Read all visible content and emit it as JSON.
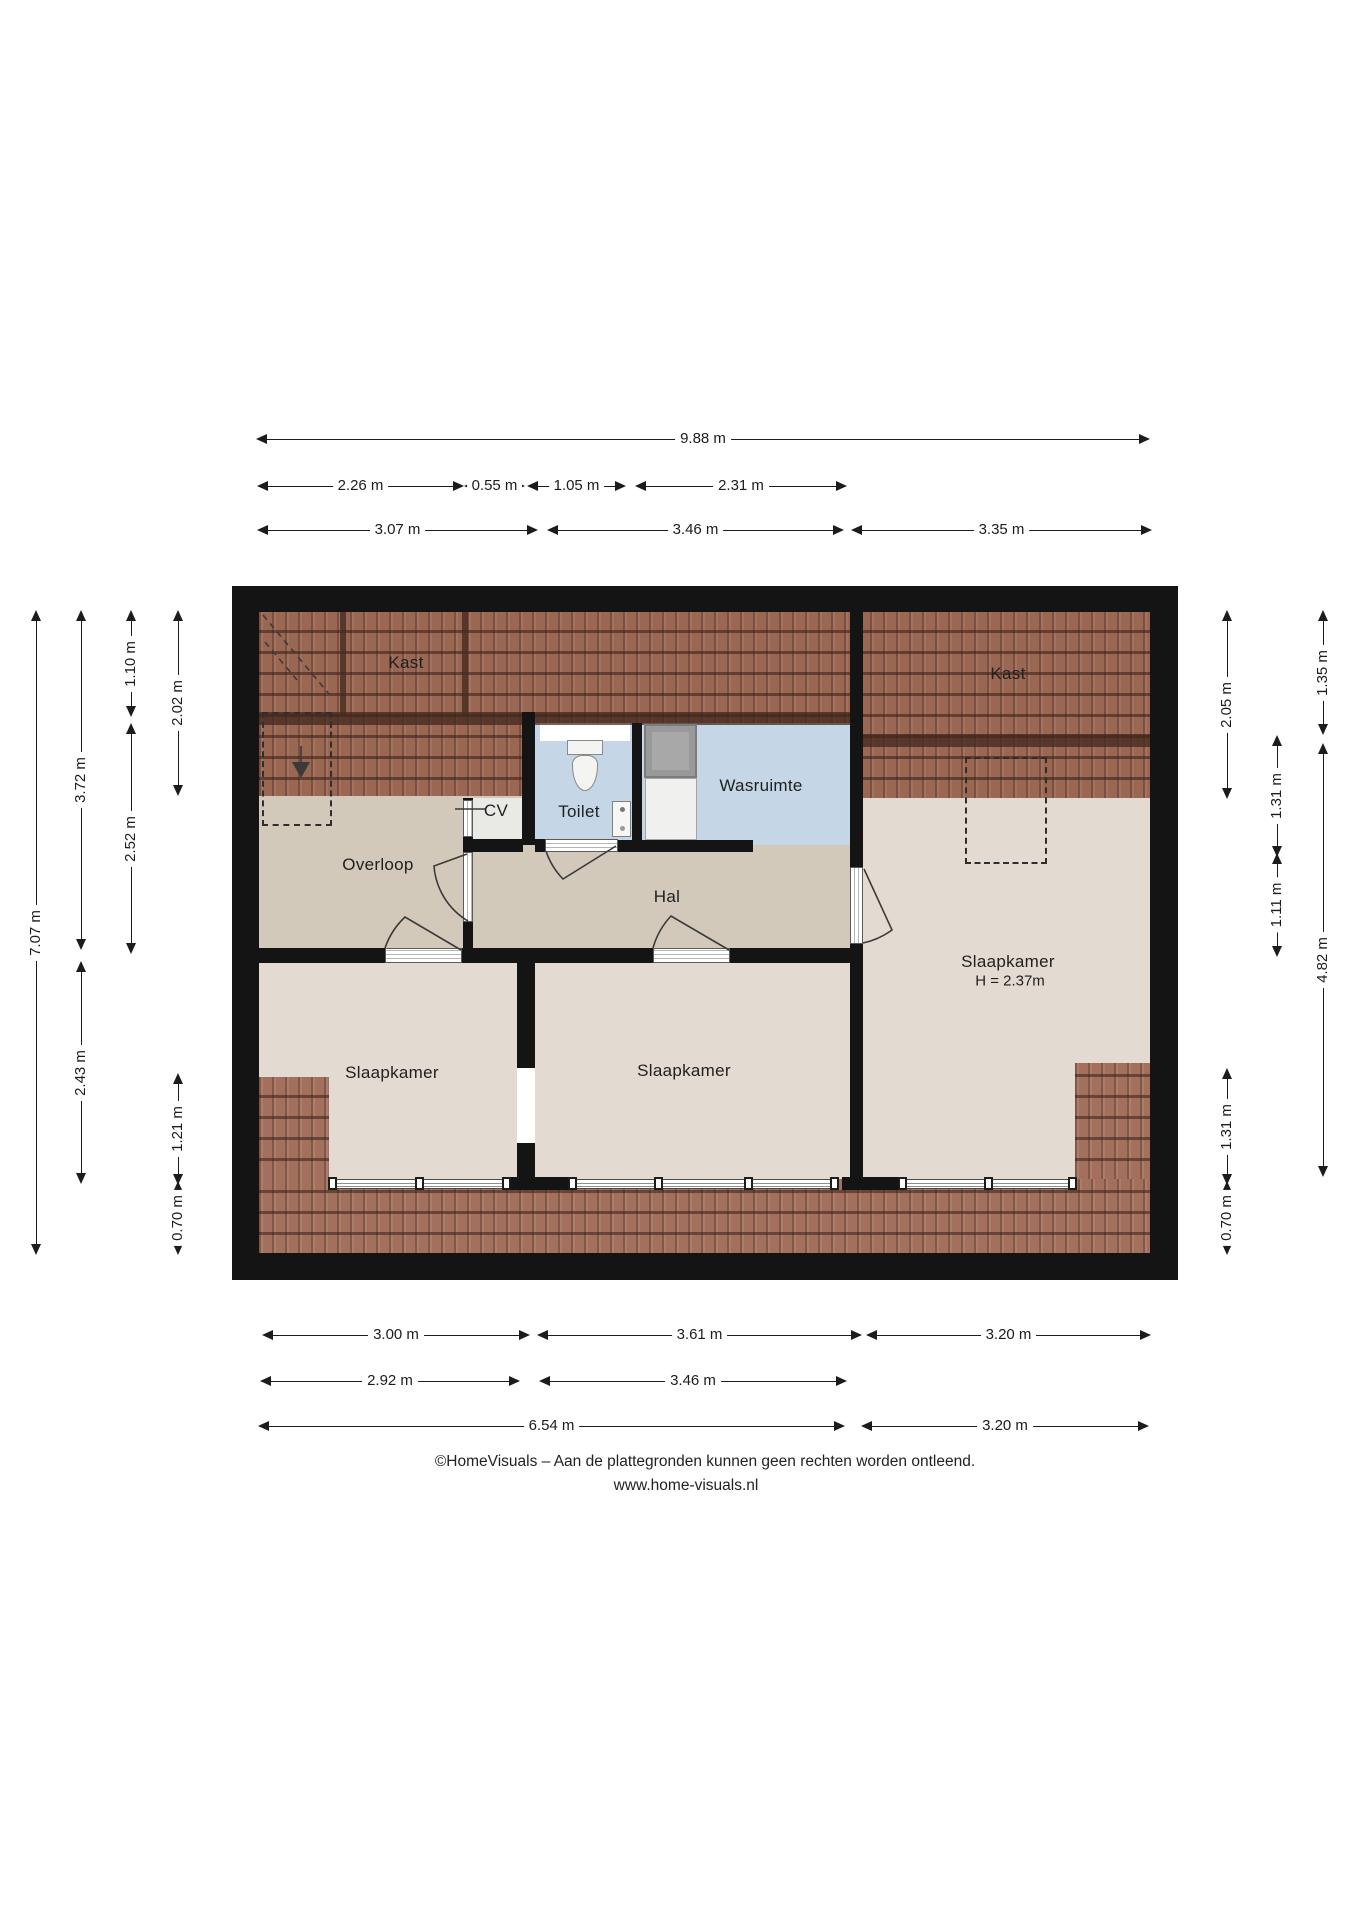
{
  "footer": {
    "line1": "©HomeVisuals – Aan de plattegronden kunnen geen rechten worden ontleend.",
    "line2": "www.home-visuals.nl"
  },
  "floorplan": {
    "rooms": [
      {
        "id": "kast-left",
        "label": "Kast",
        "x": 147,
        "y": 51
      },
      {
        "id": "kast-right",
        "label": "Kast",
        "x": 749,
        "y": 62
      },
      {
        "id": "cv",
        "label": "CV",
        "x": 237,
        "y": 199
      },
      {
        "id": "toilet",
        "label": "Toilet",
        "x": 320,
        "y": 200
      },
      {
        "id": "wasruimte",
        "label": "Wasruimte",
        "x": 502,
        "y": 174
      },
      {
        "id": "overloop",
        "label": "Overloop",
        "x": 119,
        "y": 253
      },
      {
        "id": "hal",
        "label": "Hal",
        "x": 408,
        "y": 285
      },
      {
        "id": "slaapkamer-left",
        "label": "Slaapkamer",
        "x": 133,
        "y": 461
      },
      {
        "id": "slaapkamer-mid",
        "label": "Slaapkamer",
        "x": 425,
        "y": 459
      },
      {
        "id": "slaapkamer-right",
        "label": "Slaapkamer",
        "sublabel": "H = 2.37m",
        "x": 749,
        "y": 350
      }
    ],
    "dimensions": {
      "horizontal": [
        {
          "label": "9.88 m",
          "x1": 258,
          "x2": 1148,
          "y": 439
        },
        {
          "label": "2.26 m",
          "x1": 259,
          "x2": 462,
          "y": 486
        },
        {
          "label": "0.55 m",
          "x1": 466,
          "x2": 523,
          "y": 486
        },
        {
          "label": "1.05 m",
          "x1": 529,
          "x2": 624,
          "y": 486
        },
        {
          "label": "2.31 m",
          "x1": 637,
          "x2": 845,
          "y": 486
        },
        {
          "label": "3.07 m",
          "x1": 259,
          "x2": 536,
          "y": 530
        },
        {
          "label": "3.46 m",
          "x1": 549,
          "x2": 842,
          "y": 530
        },
        {
          "label": "3.35 m",
          "x1": 853,
          "x2": 1150,
          "y": 530
        },
        {
          "label": "3.00 m",
          "x1": 264,
          "x2": 528,
          "y": 1335
        },
        {
          "label": "3.61 m",
          "x1": 539,
          "x2": 860,
          "y": 1335
        },
        {
          "label": "3.20 m",
          "x1": 868,
          "x2": 1149,
          "y": 1335
        },
        {
          "label": "2.92 m",
          "x1": 262,
          "x2": 518,
          "y": 1381
        },
        {
          "label": "3.46 m",
          "x1": 541,
          "x2": 845,
          "y": 1381
        },
        {
          "label": "6.54 m",
          "x1": 260,
          "x2": 843,
          "y": 1426
        },
        {
          "label": "3.20 m",
          "x1": 863,
          "x2": 1147,
          "y": 1426
        }
      ],
      "vertical": [
        {
          "label": "7.07 m",
          "y1": 612,
          "y2": 1253,
          "x": 36
        },
        {
          "label": "3.72 m",
          "y1": 612,
          "y2": 948,
          "x": 81
        },
        {
          "label": "2.43 m",
          "y1": 963,
          "y2": 1182,
          "x": 81
        },
        {
          "label": "1.10 m",
          "y1": 612,
          "y2": 715,
          "x": 131
        },
        {
          "label": "2.52 m",
          "y1": 725,
          "y2": 952,
          "x": 131
        },
        {
          "label": "2.02 m",
          "y1": 612,
          "y2": 794,
          "x": 178
        },
        {
          "label": "1.21 m",
          "y1": 1075,
          "y2": 1183,
          "x": 178
        },
        {
          "label": "0.70 m",
          "y1": 1183,
          "y2": 1253,
          "x": 178
        },
        {
          "label": "2.05 m",
          "y1": 612,
          "y2": 797,
          "x": 1227
        },
        {
          "label": "1.31 m",
          "y1": 1070,
          "y2": 1183,
          "x": 1227
        },
        {
          "label": "0.70 m",
          "y1": 1183,
          "y2": 1253,
          "x": 1227
        },
        {
          "label": "1.31 m",
          "y1": 737,
          "y2": 855,
          "x": 1277
        },
        {
          "label": "1.11 m",
          "y1": 855,
          "y2": 955,
          "x": 1277
        },
        {
          "label": "1.35 m",
          "y1": 612,
          "y2": 733,
          "x": 1323
        },
        {
          "label": "4.82 m",
          "y1": 745,
          "y2": 1175,
          "x": 1323
        }
      ]
    },
    "fixtures": [
      "toilet-icon",
      "sink-icon",
      "washing-machine-icon",
      "dryer-icon",
      "stairs-down-arrow-icon"
    ],
    "colors": {
      "wall": "#141414",
      "roof_tiles": "#9a6753",
      "floor_hall": "#d2c9ba",
      "floor_bedroom": "#e3dad2",
      "floor_wet_room": "#c5d6e6",
      "floor_cv": "#e9e9e6",
      "dimension_text": "#1c1c1c"
    }
  }
}
